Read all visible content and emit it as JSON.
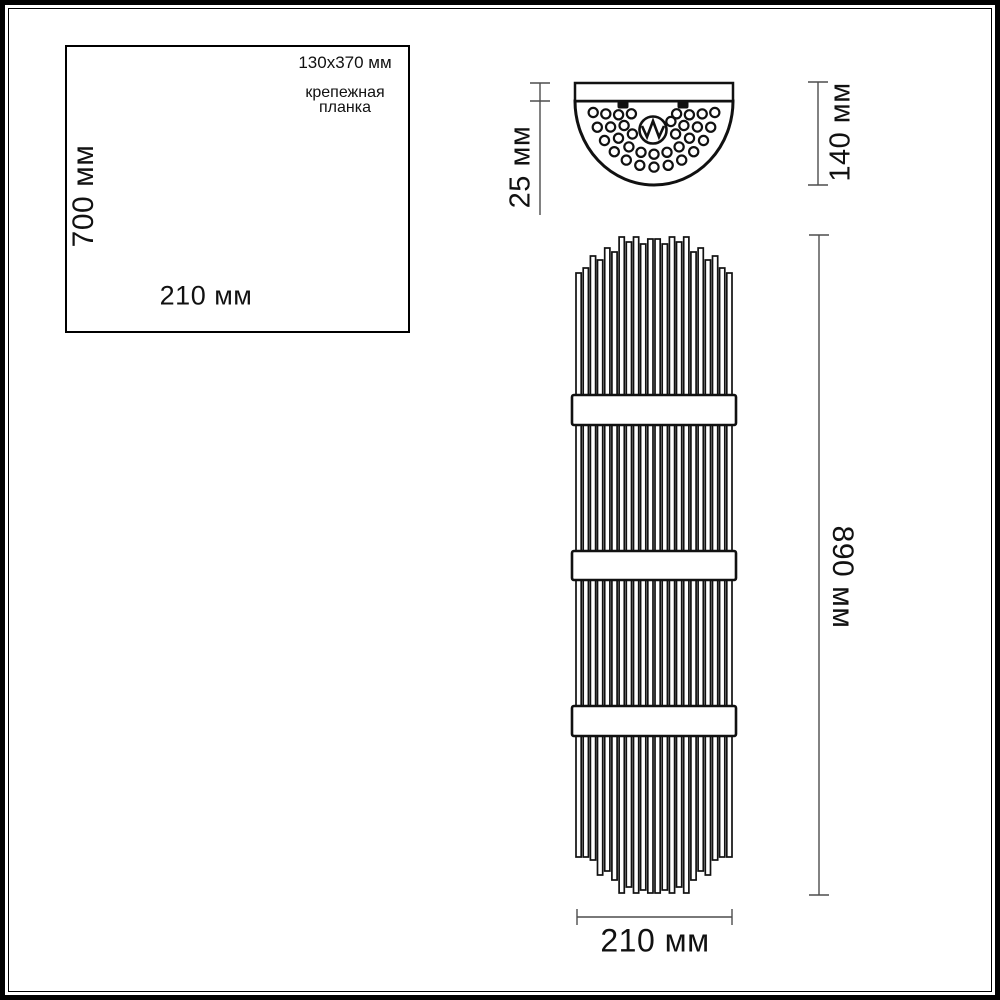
{
  "inset": {
    "height_dim": "700 мм",
    "width_dim": "210 мм",
    "annotation": {
      "size": "130x370 мм",
      "name_line1": "крепежная",
      "name_line2": "планка"
    }
  },
  "top_view": {
    "depth_dim": "25 мм",
    "height_dim": "140 мм"
  },
  "front_view": {
    "height_dim": "890 мм",
    "width_dim": "210 мм"
  },
  "colors": {
    "ink": "#111111",
    "dim_line": "#4d4d4d"
  }
}
